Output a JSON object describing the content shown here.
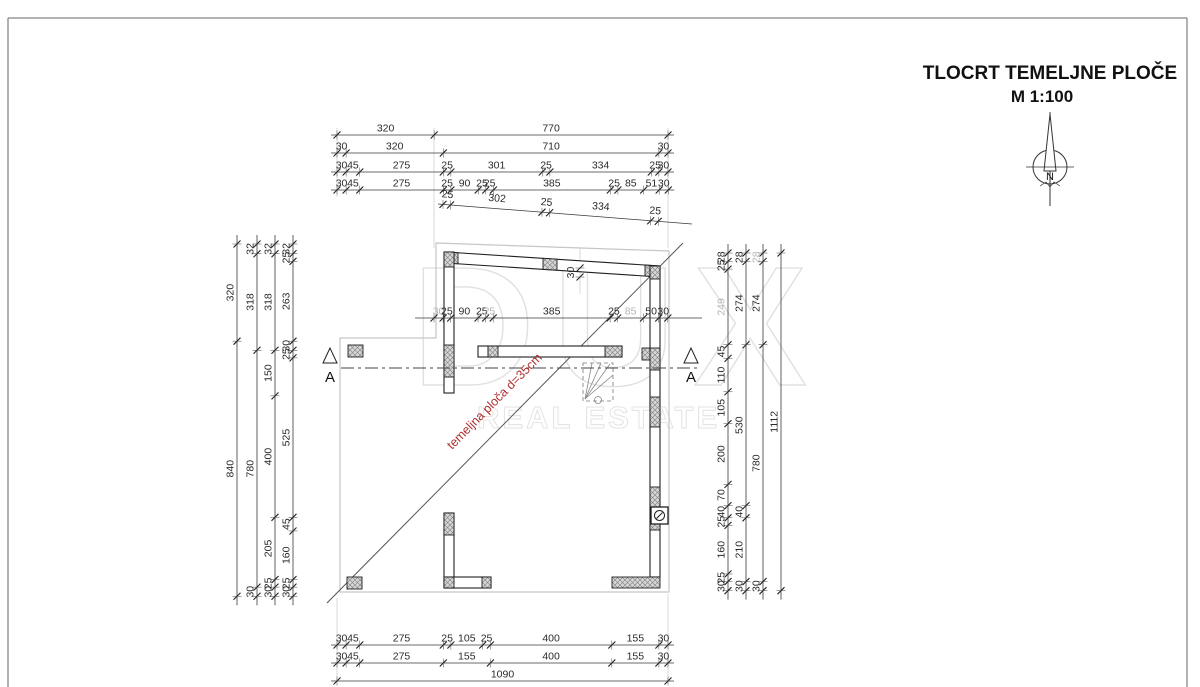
{
  "title_block": {
    "title": "TLOCRT  TEMELJNE PLOČE",
    "scale": "M 1:100",
    "north_label": "N"
  },
  "watermark": {
    "line1": "DUX",
    "line2": "REAL ESTATE"
  },
  "section": {
    "left_label": "A",
    "right_label": "A"
  },
  "slab_label": {
    "text": "temeljna ploča d=35cm",
    "color": "#b03030"
  },
  "colors": {
    "wall_outline": "#1f1f1f",
    "slab_outline": "#c6c6c6",
    "dim_text": "#2b2b2b",
    "dim_muted": "#b5b5b5",
    "watermark": "#e0e0e0"
  },
  "dimensions": {
    "scale_px_per_cm": 0.30367,
    "top_rows": [
      {
        "y": 135,
        "x0": 337,
        "values": [
          320,
          770
        ]
      },
      {
        "y": 153,
        "x0": 337,
        "values": [
          30,
          320,
          710,
          30
        ]
      },
      {
        "y": 172,
        "x0": 337,
        "values": [
          30,
          45,
          275,
          25,
          301,
          25,
          334,
          25,
          30
        ]
      },
      {
        "y": 190,
        "x0": 337,
        "values": [
          30,
          45,
          275,
          25,
          90,
          25,
          25,
          385,
          25,
          85,
          51,
          30
        ]
      }
    ],
    "slanted_row": {
      "x1": 438,
      "y1": 204,
      "x2": 692,
      "y2": 224,
      "offset": 5,
      "values": [
        25,
        302,
        25,
        334,
        25
      ]
    },
    "mid_row": {
      "y": 318,
      "x0": 434,
      "line": [
        415,
        702
      ],
      "values": [
        30,
        25,
        90,
        25,
        25,
        385,
        25,
        85,
        50,
        30
      ],
      "muted": [
        0,
        4,
        7
      ]
    },
    "bottom_rows": [
      {
        "y": 645,
        "x0": 337,
        "values": [
          30,
          45,
          275,
          25,
          105,
          25,
          400,
          155,
          30
        ]
      },
      {
        "y": 663,
        "x0": 337,
        "values": [
          30,
          45,
          275,
          155,
          400,
          155,
          30
        ]
      },
      {
        "y": 681,
        "x0": 337,
        "values": [
          1090
        ]
      }
    ],
    "left_cols": [
      {
        "x": 237,
        "y0": 244,
        "values": [
          320,
          840
        ]
      },
      {
        "x": 257,
        "y0": 244,
        "values": [
          32,
          318,
          780,
          30
        ]
      },
      {
        "x": 275,
        "y0": 244,
        "values": [
          32,
          318,
          150,
          400,
          205,
          25,
          30
        ]
      },
      {
        "x": 293,
        "y0": 244,
        "values": [
          32,
          25,
          263,
          30,
          25,
          525,
          45,
          160,
          25,
          30
        ]
      }
    ],
    "right_cols": [
      {
        "x": 728,
        "y0": 253,
        "values": [
          28,
          25,
          249,
          45,
          110,
          105,
          200,
          70,
          40,
          25,
          160,
          25,
          30
        ],
        "muted": [
          2
        ]
      },
      {
        "x": 746,
        "y0": 253,
        "values": [
          28,
          274,
          530,
          40,
          210,
          30
        ]
      },
      {
        "x": 763,
        "y0": 253,
        "values": [
          28,
          274,
          780,
          30
        ],
        "muted": [
          0
        ]
      },
      {
        "x": 781,
        "y0": 253,
        "values": [
          1112
        ]
      }
    ],
    "wall_thickness_dim": {
      "label": "30",
      "x": 580,
      "ext_y1": 247,
      "ext_y2": 294,
      "t1": 268,
      "t2": 277
    }
  }
}
